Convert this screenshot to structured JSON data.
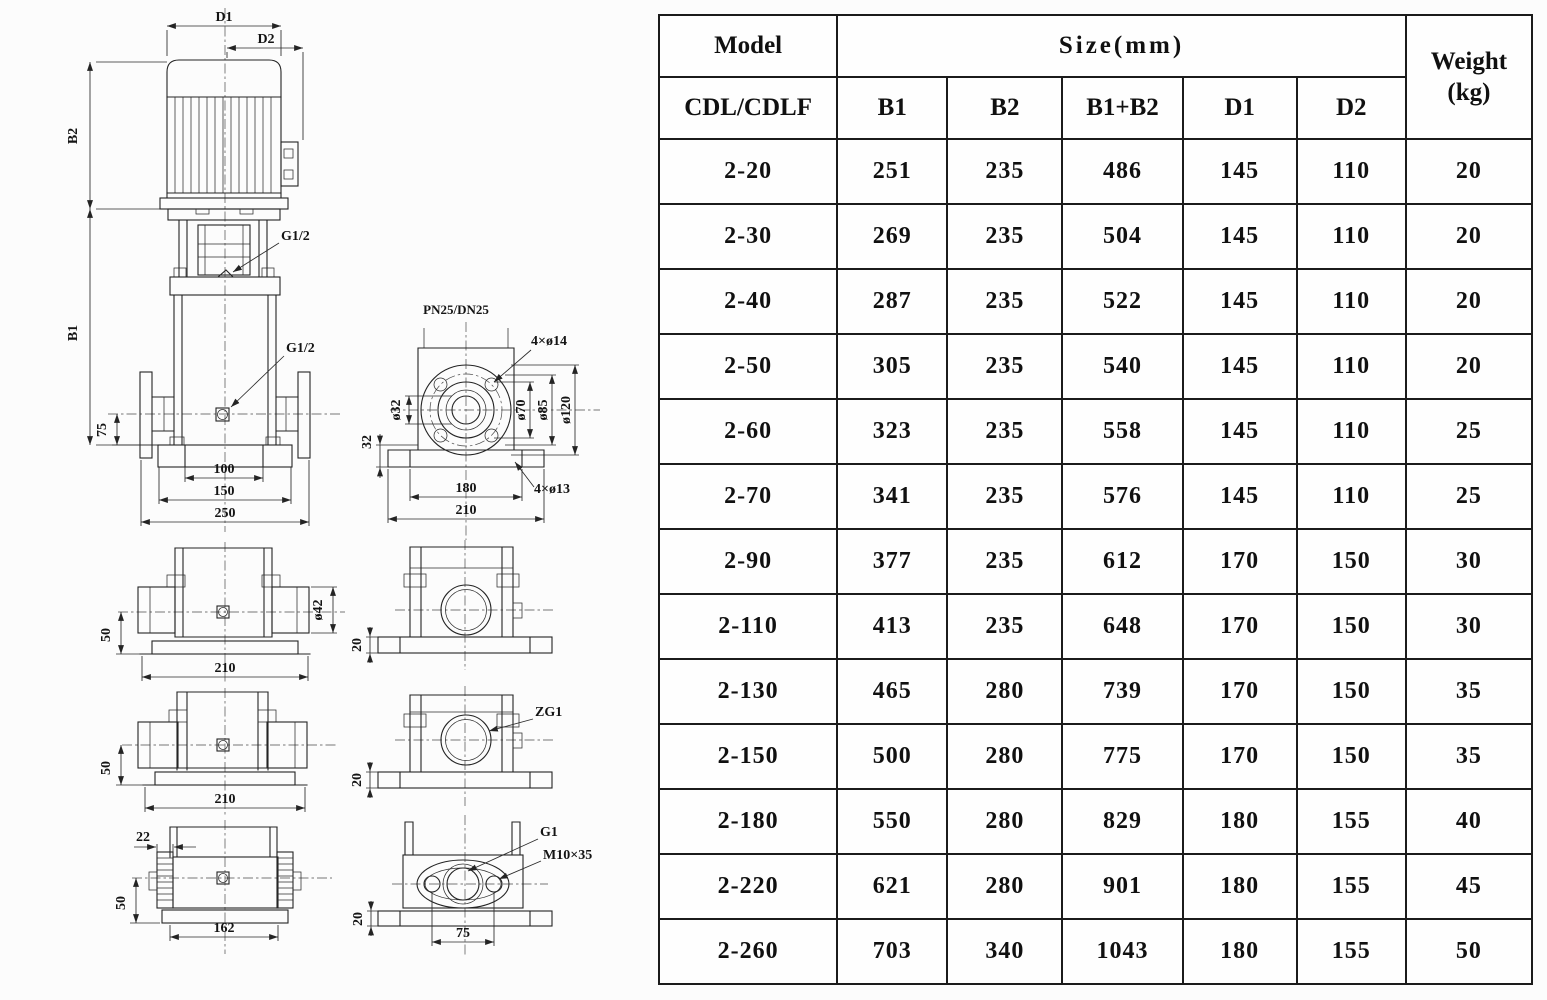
{
  "table": {
    "header": {
      "model": "Model",
      "size": "Size(mm)",
      "weight_line1": "Weight",
      "weight_line2": "(kg)",
      "sub_model": "CDL/CDLF",
      "sub_cols": [
        "B1",
        "B2",
        "B1+B2",
        "D1",
        "D2"
      ]
    },
    "rows": [
      [
        "2-20",
        "251",
        "235",
        "486",
        "145",
        "110",
        "20"
      ],
      [
        "2-30",
        "269",
        "235",
        "504",
        "145",
        "110",
        "20"
      ],
      [
        "2-40",
        "287",
        "235",
        "522",
        "145",
        "110",
        "20"
      ],
      [
        "2-50",
        "305",
        "235",
        "540",
        "145",
        "110",
        "20"
      ],
      [
        "2-60",
        "323",
        "235",
        "558",
        "145",
        "110",
        "25"
      ],
      [
        "2-70",
        "341",
        "235",
        "576",
        "145",
        "110",
        "25"
      ],
      [
        "2-90",
        "377",
        "235",
        "612",
        "170",
        "150",
        "30"
      ],
      [
        "2-110",
        "413",
        "235",
        "648",
        "170",
        "150",
        "30"
      ],
      [
        "2-130",
        "465",
        "280",
        "739",
        "170",
        "150",
        "35"
      ],
      [
        "2-150",
        "500",
        "280",
        "775",
        "170",
        "150",
        "35"
      ],
      [
        "2-180",
        "550",
        "280",
        "829",
        "180",
        "155",
        "40"
      ],
      [
        "2-220",
        "621",
        "280",
        "901",
        "180",
        "155",
        "45"
      ],
      [
        "2-260",
        "703",
        "340",
        "1043",
        "180",
        "155",
        "50"
      ]
    ]
  },
  "drawing": {
    "labels": {
      "d1": "D1",
      "d2": "D2",
      "b2": "B2",
      "b1": "B1",
      "g12_coupling": "G1/2",
      "g12_plug": "G1/2",
      "dim75": "75",
      "dim100": "100",
      "dim150": "150",
      "dim250": "250",
      "pn": "PN25/DN25",
      "holes_top": "4×ø14",
      "holes_base": "4×ø13",
      "dia32": "ø32",
      "dia70": "ø70",
      "dia85": "ø85",
      "dia120": "ø120",
      "dim32": "32",
      "dim180": "180",
      "dim210_flange": "210",
      "dia42": "ø42",
      "dim50_a": "50",
      "dim210_a": "210",
      "dim50_b": "50",
      "dim210_b": "210",
      "dim22": "22",
      "dim50_c": "50",
      "dim162": "162",
      "dim20_a": "20",
      "dim20_b": "20",
      "dim20_c": "20",
      "zg1": "ZG1",
      "g1": "G1",
      "m10x35": "M10×35",
      "dim75_b": "75"
    }
  }
}
